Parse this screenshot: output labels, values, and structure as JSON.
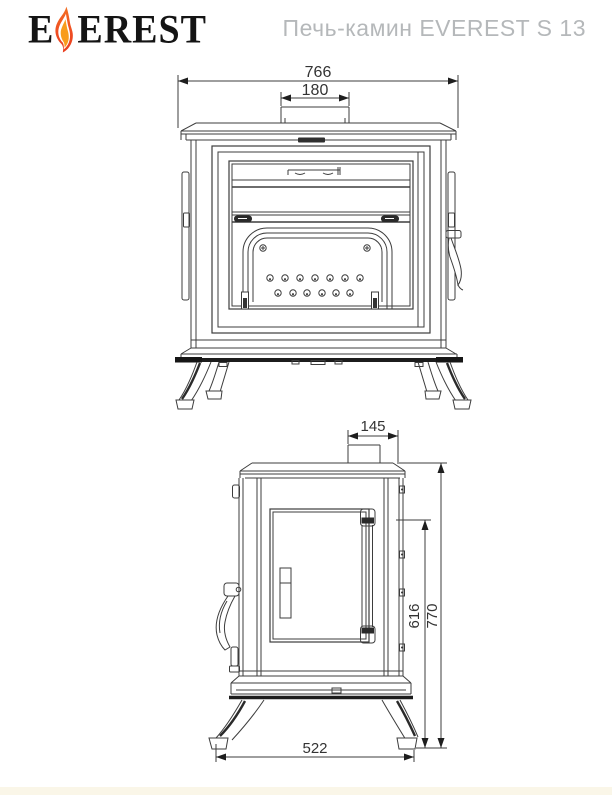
{
  "header": {
    "logo": {
      "prefix": "E",
      "suffix": "EREST"
    },
    "title": "Печь-камин EVEREST S 13"
  },
  "dims": {
    "front_total_width": "766",
    "front_flue_width": "180",
    "side_flue_offset": "145",
    "side_body_height": "616",
    "side_total_height": "770",
    "side_depth": "522"
  },
  "colors": {
    "line": "#3d3d3d",
    "title_text": "#b5b8ba",
    "logo_text": "#141414",
    "flame_outer": "#ee4a21",
    "flame_core": "#f89c1c",
    "footer_strip": "#faf6e8"
  }
}
